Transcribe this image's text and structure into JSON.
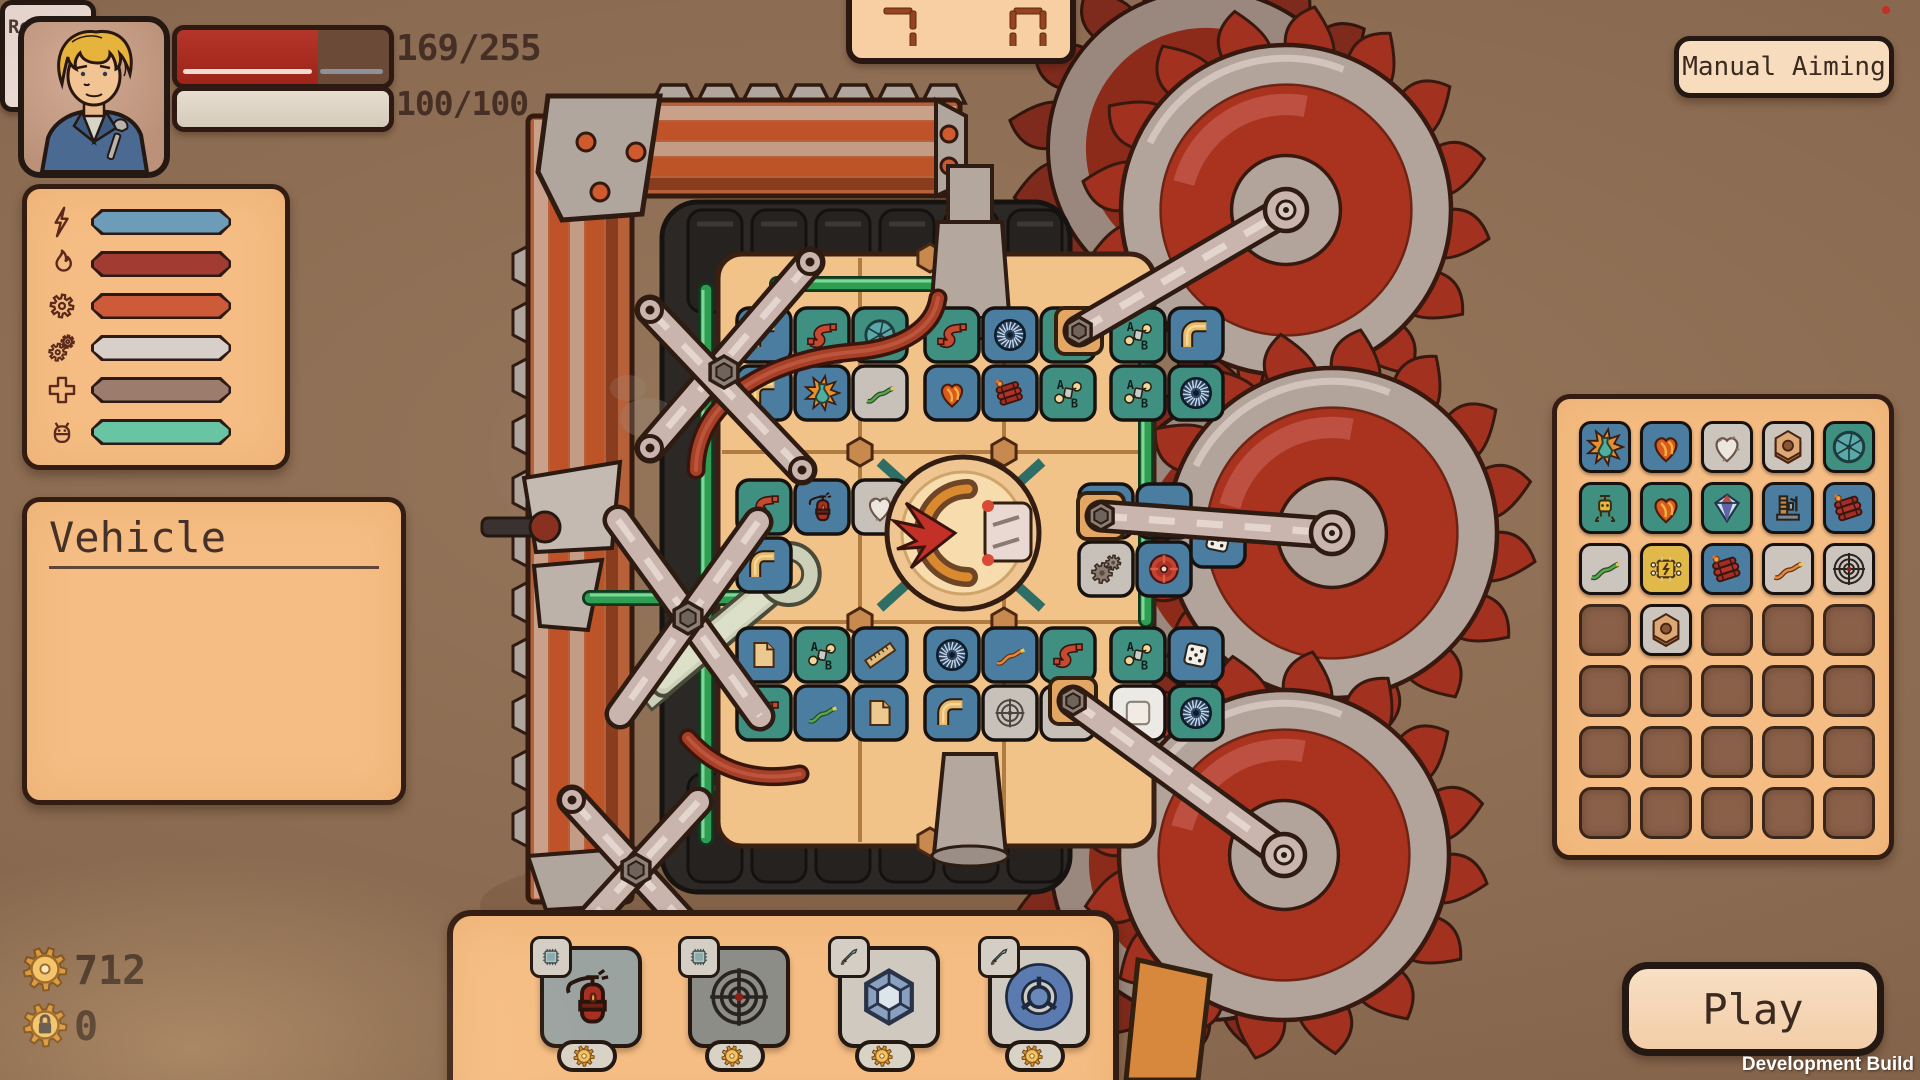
{
  "hud": {
    "portrait": "mechanic-portrait",
    "health": {
      "text": "169/255",
      "ratio": 0.663
    },
    "shield": {
      "text": "100/100",
      "ratio": 1.0
    }
  },
  "counter": {
    "left": "7",
    "right": "0"
  },
  "manual_aiming": {
    "label": "Manual Aiming"
  },
  "stats_panel": {
    "rows": [
      {
        "icon": "lightning",
        "label": "ELEKTRISCH",
        "badge_color": "#6d9cb8",
        "value": "0"
      },
      {
        "icon": "flame",
        "label": "ELEMENTAR",
        "badge_color": "#a23b32",
        "value": "0"
      },
      {
        "icon": "gear",
        "label": "PHYSIKALISCH",
        "badge_color": "#cd5a39",
        "value": "7"
      },
      {
        "icon": "gears",
        "label": "MECHANISCH",
        "badge_color": "#d9cfca",
        "value": "6"
      },
      {
        "icon": "cross",
        "label": "DEFENSIV",
        "badge_color": "#9b7c6d",
        "value": "5"
      },
      {
        "icon": "bot",
        "label": "BOT",
        "badge_color": "#69c4a3",
        "value": "2"
      }
    ]
  },
  "vehicle_panel": {
    "title": "Vehicle",
    "rows": [
      {
        "label": "Rüstung",
        "value": "48",
        "green": true
      },
      {
        "label": "Schaden erhalten",
        "value": "51 %",
        "green": false
      },
      {
        "label": "Fahrzeugtempo",
        "value": "60",
        "green": true
      },
      {
        "label": "Leben Reparatur",
        "value": "4/s",
        "green": true
      },
      {
        "label": "Schild Erzeugung",
        "value": "0/s",
        "green": false
      },
      {
        "label": "Dampf Erzeugung",
        "value": "7/s",
        "green": true
      },
      {
        "label": "Aufsammelbereich",
        "value": "6",
        "green": false
      }
    ]
  },
  "currency": [
    {
      "icon": "coin",
      "value": "712"
    },
    {
      "icon": "coinlock",
      "value": "0"
    }
  ],
  "shop": {
    "refresh": {
      "label": "Refresh",
      "count": "49",
      "icon": "coin"
    },
    "items": [
      {
        "icon": "extinguisher",
        "price": "21",
        "badge": "chip",
        "tile_color": "#9ba3a1"
      },
      {
        "icon": "crosshair",
        "price": "9",
        "badge": "chip",
        "tile_color": "#8d8d87"
      },
      {
        "icon": "gem",
        "price": "15",
        "badge": "sword",
        "tile_color": "#cfc9c0"
      },
      {
        "icon": "ring",
        "price": "15",
        "badge": "sword",
        "tile_color": "#cfc9c0"
      }
    ]
  },
  "inventory": {
    "cols": 5,
    "rows": 7,
    "items": [
      {
        "r": 0,
        "c": 0,
        "icon": "explosion",
        "color": "#4a7da0"
      },
      {
        "r": 0,
        "c": 1,
        "icon": "fireheart",
        "color": "#4a7da0"
      },
      {
        "r": 0,
        "c": 2,
        "icon": "heart",
        "color": "#ccc5be"
      },
      {
        "r": 0,
        "c": 3,
        "icon": "nut",
        "color": "#ccc5be"
      },
      {
        "r": 0,
        "c": 4,
        "icon": "shutter",
        "color": "#3f9080"
      },
      {
        "r": 1,
        "c": 0,
        "icon": "robot",
        "color": "#3f9080"
      },
      {
        "r": 1,
        "c": 1,
        "icon": "fireheart",
        "color": "#3f9080"
      },
      {
        "r": 1,
        "c": 2,
        "icon": "diamond",
        "color": "#3f9080"
      },
      {
        "r": 1,
        "c": 3,
        "icon": "machine",
        "color": "#4a7da0"
      },
      {
        "r": 1,
        "c": 4,
        "icon": "dynamite",
        "color": "#4a7da0"
      },
      {
        "r": 2,
        "c": 0,
        "icon": "wiregreen",
        "color": "#ccc5be"
      },
      {
        "r": 2,
        "c": 1,
        "icon": "chip",
        "color": "#e0b94a"
      },
      {
        "r": 2,
        "c": 2,
        "icon": "dynamite",
        "color": "#4a7da0"
      },
      {
        "r": 2,
        "c": 3,
        "icon": "wireorange",
        "color": "#ccc5be"
      },
      {
        "r": 2,
        "c": 4,
        "icon": "crosshair",
        "color": "#ccc5be"
      },
      {
        "r": 3,
        "c": 1,
        "icon": "nut",
        "color": "#ccc5be"
      }
    ]
  },
  "play": {
    "label": "Play"
  },
  "dev_build": "Development Build",
  "vehicle_tiles": [
    {
      "x": 737,
      "y": 308,
      "c": "b",
      "i": "pipe"
    },
    {
      "x": 795,
      "y": 308,
      "c": "t",
      "i": "spipe"
    },
    {
      "x": 853,
      "y": 308,
      "c": "t",
      "i": "shutter"
    },
    {
      "x": 925,
      "y": 308,
      "c": "t",
      "i": "spipe"
    },
    {
      "x": 983,
      "y": 308,
      "c": "b",
      "i": "fan"
    },
    {
      "x": 1041,
      "y": 308,
      "c": "t",
      "i": "ab"
    },
    {
      "x": 1111,
      "y": 308,
      "c": "t",
      "i": "ab"
    },
    {
      "x": 1169,
      "y": 308,
      "c": "b",
      "i": "pipe"
    },
    {
      "x": 737,
      "y": 366,
      "c": "b",
      "i": "pipe"
    },
    {
      "x": 795,
      "y": 366,
      "c": "b",
      "i": "explosion"
    },
    {
      "x": 853,
      "y": 366,
      "c": "g",
      "i": "wiregreen"
    },
    {
      "x": 925,
      "y": 366,
      "c": "b",
      "i": "fireheart"
    },
    {
      "x": 983,
      "y": 366,
      "c": "b",
      "i": "dynamite"
    },
    {
      "x": 1041,
      "y": 366,
      "c": "t",
      "i": "ab"
    },
    {
      "x": 1111,
      "y": 366,
      "c": "t",
      "i": "ab"
    },
    {
      "x": 1169,
      "y": 366,
      "c": "t",
      "i": "fan"
    },
    {
      "x": 737,
      "y": 480,
      "c": "t",
      "i": "spipe"
    },
    {
      "x": 795,
      "y": 480,
      "c": "b",
      "i": "extinguisher"
    },
    {
      "x": 853,
      "y": 480,
      "c": "g",
      "i": "heart"
    },
    {
      "x": 737,
      "y": 538,
      "c": "b",
      "i": "pipe"
    },
    {
      "x": 1079,
      "y": 484,
      "c": "b",
      "i": "fan"
    },
    {
      "x": 1137,
      "y": 484,
      "c": "b",
      "i": "gun"
    },
    {
      "x": 1079,
      "y": 542,
      "c": "g",
      "i": "gearsgray"
    },
    {
      "x": 1137,
      "y": 542,
      "c": "b",
      "i": "wheel"
    },
    {
      "x": 1191,
      "y": 513,
      "c": "b",
      "i": "dice"
    },
    {
      "x": 737,
      "y": 628,
      "c": "b",
      "i": "paper"
    },
    {
      "x": 795,
      "y": 628,
      "c": "t",
      "i": "ab"
    },
    {
      "x": 853,
      "y": 628,
      "c": "b",
      "i": "ruler"
    },
    {
      "x": 925,
      "y": 628,
      "c": "b",
      "i": "fan"
    },
    {
      "x": 983,
      "y": 628,
      "c": "b",
      "i": "wireorange"
    },
    {
      "x": 1041,
      "y": 628,
      "c": "t",
      "i": "spipe"
    },
    {
      "x": 1111,
      "y": 628,
      "c": "t",
      "i": "ab"
    },
    {
      "x": 1169,
      "y": 628,
      "c": "b",
      "i": "dice"
    },
    {
      "x": 737,
      "y": 686,
      "c": "t",
      "i": "spipe"
    },
    {
      "x": 795,
      "y": 686,
      "c": "b",
      "i": "wiregreen"
    },
    {
      "x": 853,
      "y": 686,
      "c": "b",
      "i": "paper"
    },
    {
      "x": 925,
      "y": 686,
      "c": "b",
      "i": "pipe"
    },
    {
      "x": 983,
      "y": 686,
      "c": "g",
      "i": "target"
    },
    {
      "x": 1041,
      "y": 686,
      "c": "g",
      "i": "blank"
    },
    {
      "x": 1111,
      "y": 686,
      "c": "w",
      "i": "squarewhite"
    },
    {
      "x": 1169,
      "y": 686,
      "c": "t",
      "i": "fan"
    }
  ]
}
